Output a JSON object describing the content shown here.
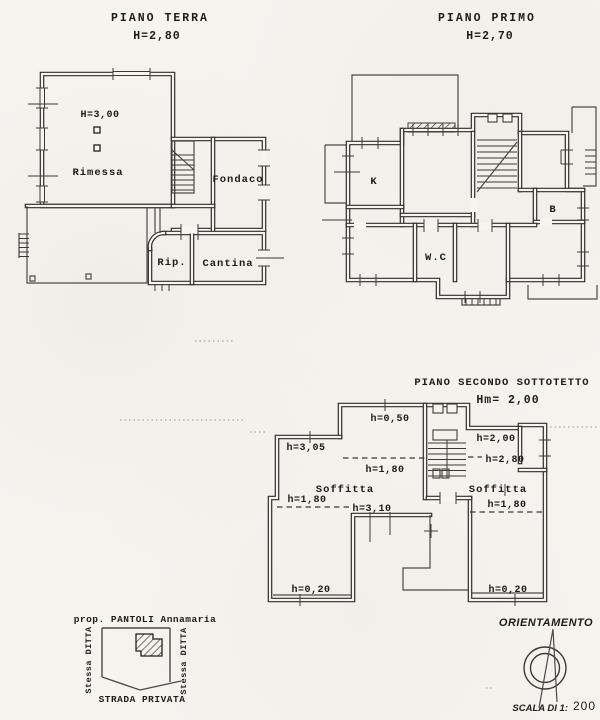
{
  "page": {
    "background": "#f6f4ef",
    "ink": "#2e2d2a"
  },
  "floors": {
    "terra": {
      "title": "PIANO TERRA",
      "height": "H=2,80",
      "rooms": {
        "ceiling": "H=3,00",
        "rimessa": "Rimessa",
        "fondaco": "Fondaco",
        "rip": "Rip.",
        "cantina": "Cantina"
      }
    },
    "primo": {
      "title": "PIANO PRIMO",
      "height": "H=2,70",
      "rooms": {
        "kitchen": "K",
        "bath": "B",
        "wc": "W.C"
      }
    },
    "secondo": {
      "title": "PIANO SECONDO SOTTOTETTO",
      "height": "Hm= 2,00",
      "rooms": {
        "h050": "h=0,50",
        "h305": "h=3,05",
        "h180_center": "h=1,80",
        "h180_left": "h=1,80",
        "h180_right": "h=1,80",
        "h200": "h=2,00",
        "h280": "h=2,80",
        "h310": "h=3,10",
        "soffitta_left": "Soffitta",
        "soffitta_right": "Soffitta",
        "h020_left": "h=0,20",
        "h020_right": "h=0,20"
      }
    }
  },
  "site_plan": {
    "owner": "prop. PANTOLI Annamaria",
    "neighbor_left": "Stessa DITTA",
    "neighbor_right": "Stessa DITTA",
    "road": "STRADA PRIVATA"
  },
  "orientation": {
    "label": "ORIENTAMENTO",
    "scale_label": "SCALA DI 1:",
    "scale_value": "200"
  }
}
